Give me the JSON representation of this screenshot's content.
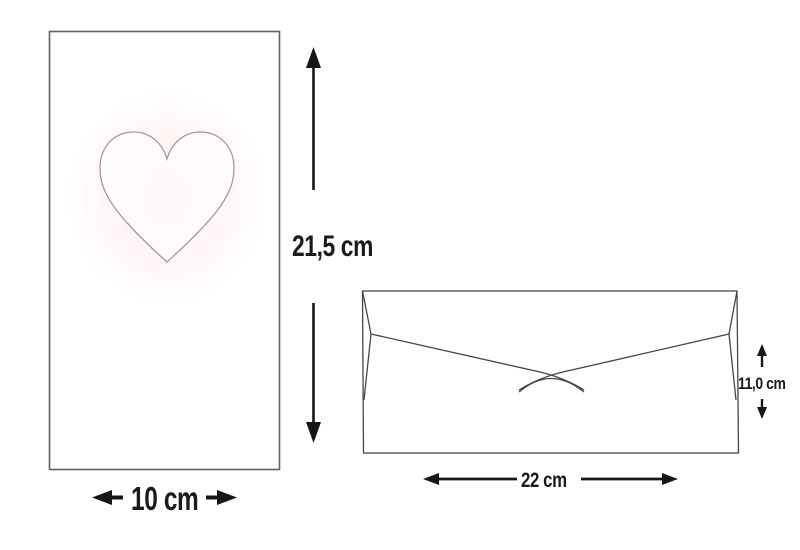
{
  "diagram": {
    "card": {
      "shape": "tall-rectangle",
      "motif": "heart-outline",
      "height_label": "21,5 cm",
      "width_label": "10 cm"
    },
    "envelope": {
      "shape": "envelope-back-with-flap",
      "width_label": "22 cm",
      "height_label": "11,0 cm"
    },
    "colors": {
      "background": "#ffffff",
      "card_outline": "#606060",
      "envelope_outline": "#454545",
      "heart_outline": "#9d9d9d",
      "heart_glow": "#fdecec",
      "dimension_arrows_and_text": "#1a1a1a"
    }
  }
}
